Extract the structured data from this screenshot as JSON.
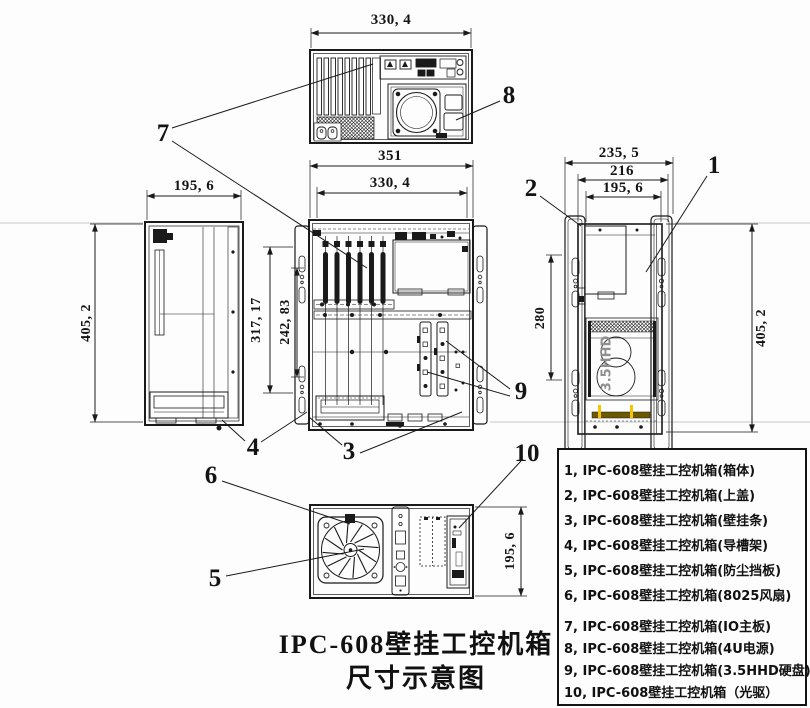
{
  "title": {
    "line1": "IPC-608壁挂工控机箱",
    "line2": "尺寸示意图"
  },
  "dimensions": {
    "top_view_width": "330, 4",
    "front_view_outer_width": "351",
    "front_view_inner_width": "330, 4",
    "front_view_height_outer": "317, 17",
    "front_view_height_inner": "242, 83",
    "left_view_width": "195, 6",
    "left_view_height": "405, 2",
    "right_view_width_outer": "235, 5",
    "right_view_width_mid": "216",
    "right_view_width_inner": "195, 6",
    "right_view_height": "405, 2",
    "right_view_inner_height": "280",
    "bottom_view_height": "195, 6"
  },
  "labels": {
    "hdd": "3.5HHD"
  },
  "callouts": {
    "n1": "1",
    "n2": "2",
    "n3": "3",
    "n4": "4",
    "n5": "5",
    "n6": "6",
    "n7": "7",
    "n8": "8",
    "n9": "9",
    "n10": "10"
  },
  "legend": {
    "items": [
      "1, IPC-608壁挂工控机箱(箱体)",
      "2, IPC-608壁挂工控机箱(上盖)",
      "3, IPC-608壁挂工控机箱(壁挂条)",
      "4, IPC-608壁挂工控机箱(导槽架)",
      "5, IPC-608壁挂工控机箱(防尘挡板)",
      "6, IPC-608壁挂工控机箱(8025风扇)",
      "7, IPC-608壁挂工控机箱(IO主板)",
      "8, IPC-608壁挂工控机箱(4U电源)",
      "9, IPC-608壁挂工控机箱(3.5HHD硬盘)",
      "10, IPC-608壁挂工控机箱（光驱）"
    ]
  },
  "colors": {
    "line": "#1a1a1a",
    "highlight_yellow": "#f6c400",
    "highlight_olive": "#6b5900",
    "hdd_text": "#8f8f8f",
    "background": "#fdfdfd"
  }
}
